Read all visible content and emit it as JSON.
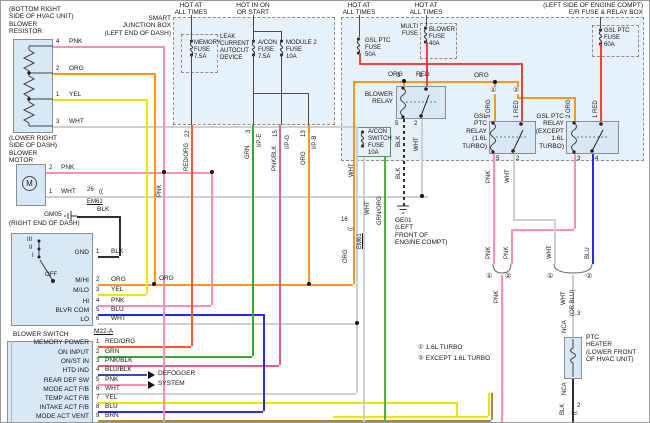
{
  "wires": {
    "pnk": "PNK",
    "org": "ORG",
    "yel": "YEL",
    "wht": "WHT",
    "blk": "BLK",
    "blu": "BLU",
    "brn": "BRN",
    "red": "RED",
    "grn": "GRN",
    "rorg": "RED/ORG",
    "pblk": "PNK/BLK",
    "bblk": "BLU/BLK",
    "gorg": "GRN/ORG",
    "org3": "3 ORG",
    "org2": "2 ORG",
    "red1": "1 RED",
    "orblu": "(OR BLU)",
    "conn": "(("
  },
  "resistor": {
    "title": "(BOTTOM RIGHT\nSIDE OF HVAC UNIT)\nBLOWER\nRESISTOR",
    "pins": [
      {
        "n": "4",
        "w": "PNK"
      },
      {
        "n": "2",
        "w": "ORG"
      },
      {
        "n": "1",
        "w": "YEL"
      },
      {
        "n": "3",
        "w": "WHT"
      }
    ]
  },
  "motor": {
    "title": "(LOWER RIGHT\nSIDE OF DASH)\nBLOWER\nMOTOR",
    "m": "M",
    "pins": [
      {
        "n": "2",
        "w": "PNK"
      },
      {
        "n": "1",
        "w": "WHT"
      }
    ]
  },
  "gm05": {
    "name": "GM05",
    "wire": "BLK"
  },
  "right_end": "(RIGHT END OF DASH)",
  "em61_26": {
    "pin": "26",
    "name": "EM61"
  },
  "em61_16": {
    "pin": "16",
    "name": "EM61"
  },
  "bswitch": {
    "title": "BLOWER SWITCH",
    "connector": "M22-A",
    "pos": [
      "III",
      "II",
      "I",
      "OFF"
    ],
    "pins": [
      {
        "t": "GND",
        "n": "1",
        "w": "BLK"
      },
      {
        "t": "M/HI",
        "n": "2",
        "w": "ORG"
      },
      {
        "t": "M/LO",
        "n": "3",
        "w": "YEL"
      },
      {
        "t": "HI",
        "n": "4",
        "w": "PNK"
      },
      {
        "t": "BLVR COM",
        "n": "5",
        "w": "BLU"
      },
      {
        "t": "LO",
        "n": "6",
        "w": "WHT"
      }
    ]
  },
  "acc": {
    "rows": [
      {
        "t": "MEMORY POWER",
        "n": "1",
        "w": "RED/ORG"
      },
      {
        "t": "ON INPUT",
        "n": "2",
        "w": "GRN"
      },
      {
        "t": "ON/ST IN",
        "n": "3",
        "w": "PNK/BLK"
      },
      {
        "t": "HTD IND",
        "n": "4",
        "w": "BLU/BLK"
      },
      {
        "t": "REAR DEF SW",
        "n": "5",
        "w": "PNK"
      },
      {
        "t": "MODE ACT F/B",
        "n": "6",
        "w": "WHT"
      },
      {
        "t": "TEMP ACT F/B",
        "n": "7",
        "w": "YEL"
      },
      {
        "t": "INTAKE ACT F/B",
        "n": "8",
        "w": "BLU"
      },
      {
        "t": "MODE ACT VENT",
        "n": "9",
        "w": "BRN"
      }
    ],
    "arrow1": "DEFOGGER",
    "arrow2": "SYSTEM"
  },
  "sjb": {
    "title": "SMART\nJUNCTION BOX\n(LEFT END OF DASH)",
    "h1": "HOT AT\nALL TIMES",
    "h2": "HOT IN ON\nOR START",
    "leak": "LEAK\nCURRENT\nAUTOCUT\nDEVICE",
    "f1": "MEMORY\nFUSE\n7.5A",
    "f2": "A/CON\nFUSE\n7.5A",
    "f3": "MODULE 2\nFUSE\n10A",
    "p22": "22",
    "p3": "3",
    "p15": "15",
    "p13": "13",
    "c3": "I/P-E",
    "c15": "I/P-G",
    "c13": "I/P-B"
  },
  "er": {
    "title": "(LEFT SIDE OF ENGINE COMPT)\nE/R FUSE & RELAY BOX",
    "h3": "HOT AT\nALL TIMES",
    "h4": "HOT AT\nALL TIMES",
    "f50": "GSL PTC\nFUSE\n50A",
    "multi": "MULTI\nFUSE",
    "f40": "BLOWER\nFUSE\n40A",
    "f60": "GSL PTC\nFUSE\n60A"
  },
  "brelay": {
    "title": "BLOWER\nRELAY",
    "p3": "3",
    "p1": "1",
    "p5": "5",
    "p2": "2"
  },
  "trelay": {
    "title": "GSL\nPTC\nRELAY\n(1.6L\nTURBO)",
    "p5": "5",
    "p2": "2"
  },
  "xrelay": {
    "title": "GSL PTC\nRELAY\n(EXCEPT\n1.6L\nTURBO)",
    "p3": "3",
    "p4": "4"
  },
  "acsw": {
    "name": "A/CON\nSWITCH\nFUSE\n10A"
  },
  "ge01": {
    "name": "GE01\n(LEFT\nFRONT OF\nENGINE COMPT)"
  },
  "heater": {
    "title": "PTC\nHEATER\n(LOWER FRONT\nOF HVAC UNIT)",
    "nca": "NCA",
    "p3": "3",
    "p2": "2"
  },
  "legend": {
    "i1": "① 1.6L TURBO",
    "i2": "② EXCEPT 1.6L TURBO"
  },
  "marks": {
    "c1": "①",
    "c2": "②"
  }
}
